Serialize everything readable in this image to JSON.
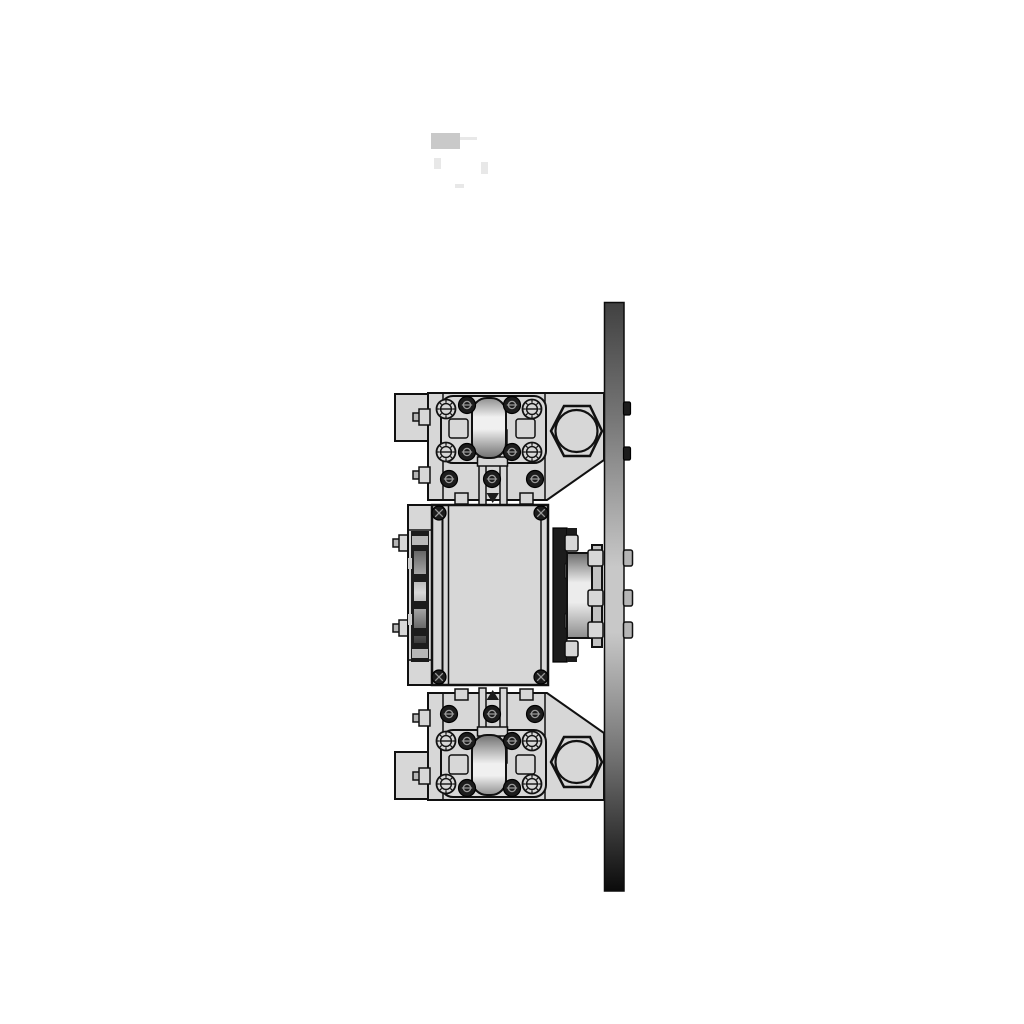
{
  "meta": {
    "title": "Mechanical roller-bracket assembly, side elevation (CAD render)",
    "canvas": {
      "width": 1024,
      "height": 1024
    },
    "background": "#ffffff",
    "visible_text_labels": []
  },
  "colors": {
    "outline": "#111111",
    "body": "#d7d7d7",
    "body_dark": "#c2c2c2",
    "hardware_dark": "#1c1c1c",
    "screw_tick": "#9a9a9a",
    "tab_gray": "#b5b5b5",
    "band_gray": "#b8b8b8",
    "notch_gray": "#cfcfcf",
    "plate_grad_top": "#414141",
    "plate_grad_upper": "#777777",
    "plate_grad_mid": "#c8c8c8",
    "plate_grad_lower": "#6e6e6e",
    "plate_grad_bottom": "#0b0b0b",
    "roller_grad_top": "#8f8f8f",
    "roller_grad_hi": "#f0f0f0",
    "roller_grad_bottom": "#707070",
    "cyl_grad_top": "#6b6b6b",
    "cyl_grad_hi": "#ececec",
    "cyl_grad_bottom": "#8c8c8c",
    "core_grad_top": "#666666",
    "core_grad_hi": "#d8d8d8",
    "core_grad_bottom": "#3a3a3a",
    "ghost_gray": "#c9c9c9",
    "ghost_faint": "#e8e8e8"
  },
  "parts": {
    "mounting_plate": {
      "name": "vertical mounting plate",
      "finish": "gradient steel, dark top and bottom, light mid-section",
      "through_bolt_tips_right_side": 5
    },
    "top_bracket": {
      "name": "upper roller bracket",
      "serrated_socket_screws": 4,
      "button_head_screws": 7,
      "side_bolts_left": 2,
      "large_hex_nut": 1,
      "roller": 1,
      "gusset_to_plate": true
    },
    "bottom_bracket": {
      "name": "lower roller bracket (mirror of upper)",
      "serrated_socket_screws": 4,
      "button_head_screws": 7,
      "side_bolts_left": 2,
      "large_hex_nut": 1,
      "roller": 1,
      "gusset_to_plate": true
    },
    "gear_housing": {
      "name": "central gear housing block",
      "corner_screws": 4,
      "side_bolts_left": 2,
      "left_bearing_stack": 1
    },
    "shaft_coupling": {
      "name": "output shaft coupling to plate",
      "flange_bolts": 4,
      "hub_bolts": 3
    },
    "ghost_marks": {
      "name": "faded print artifact near top",
      "elements": 5
    }
  }
}
